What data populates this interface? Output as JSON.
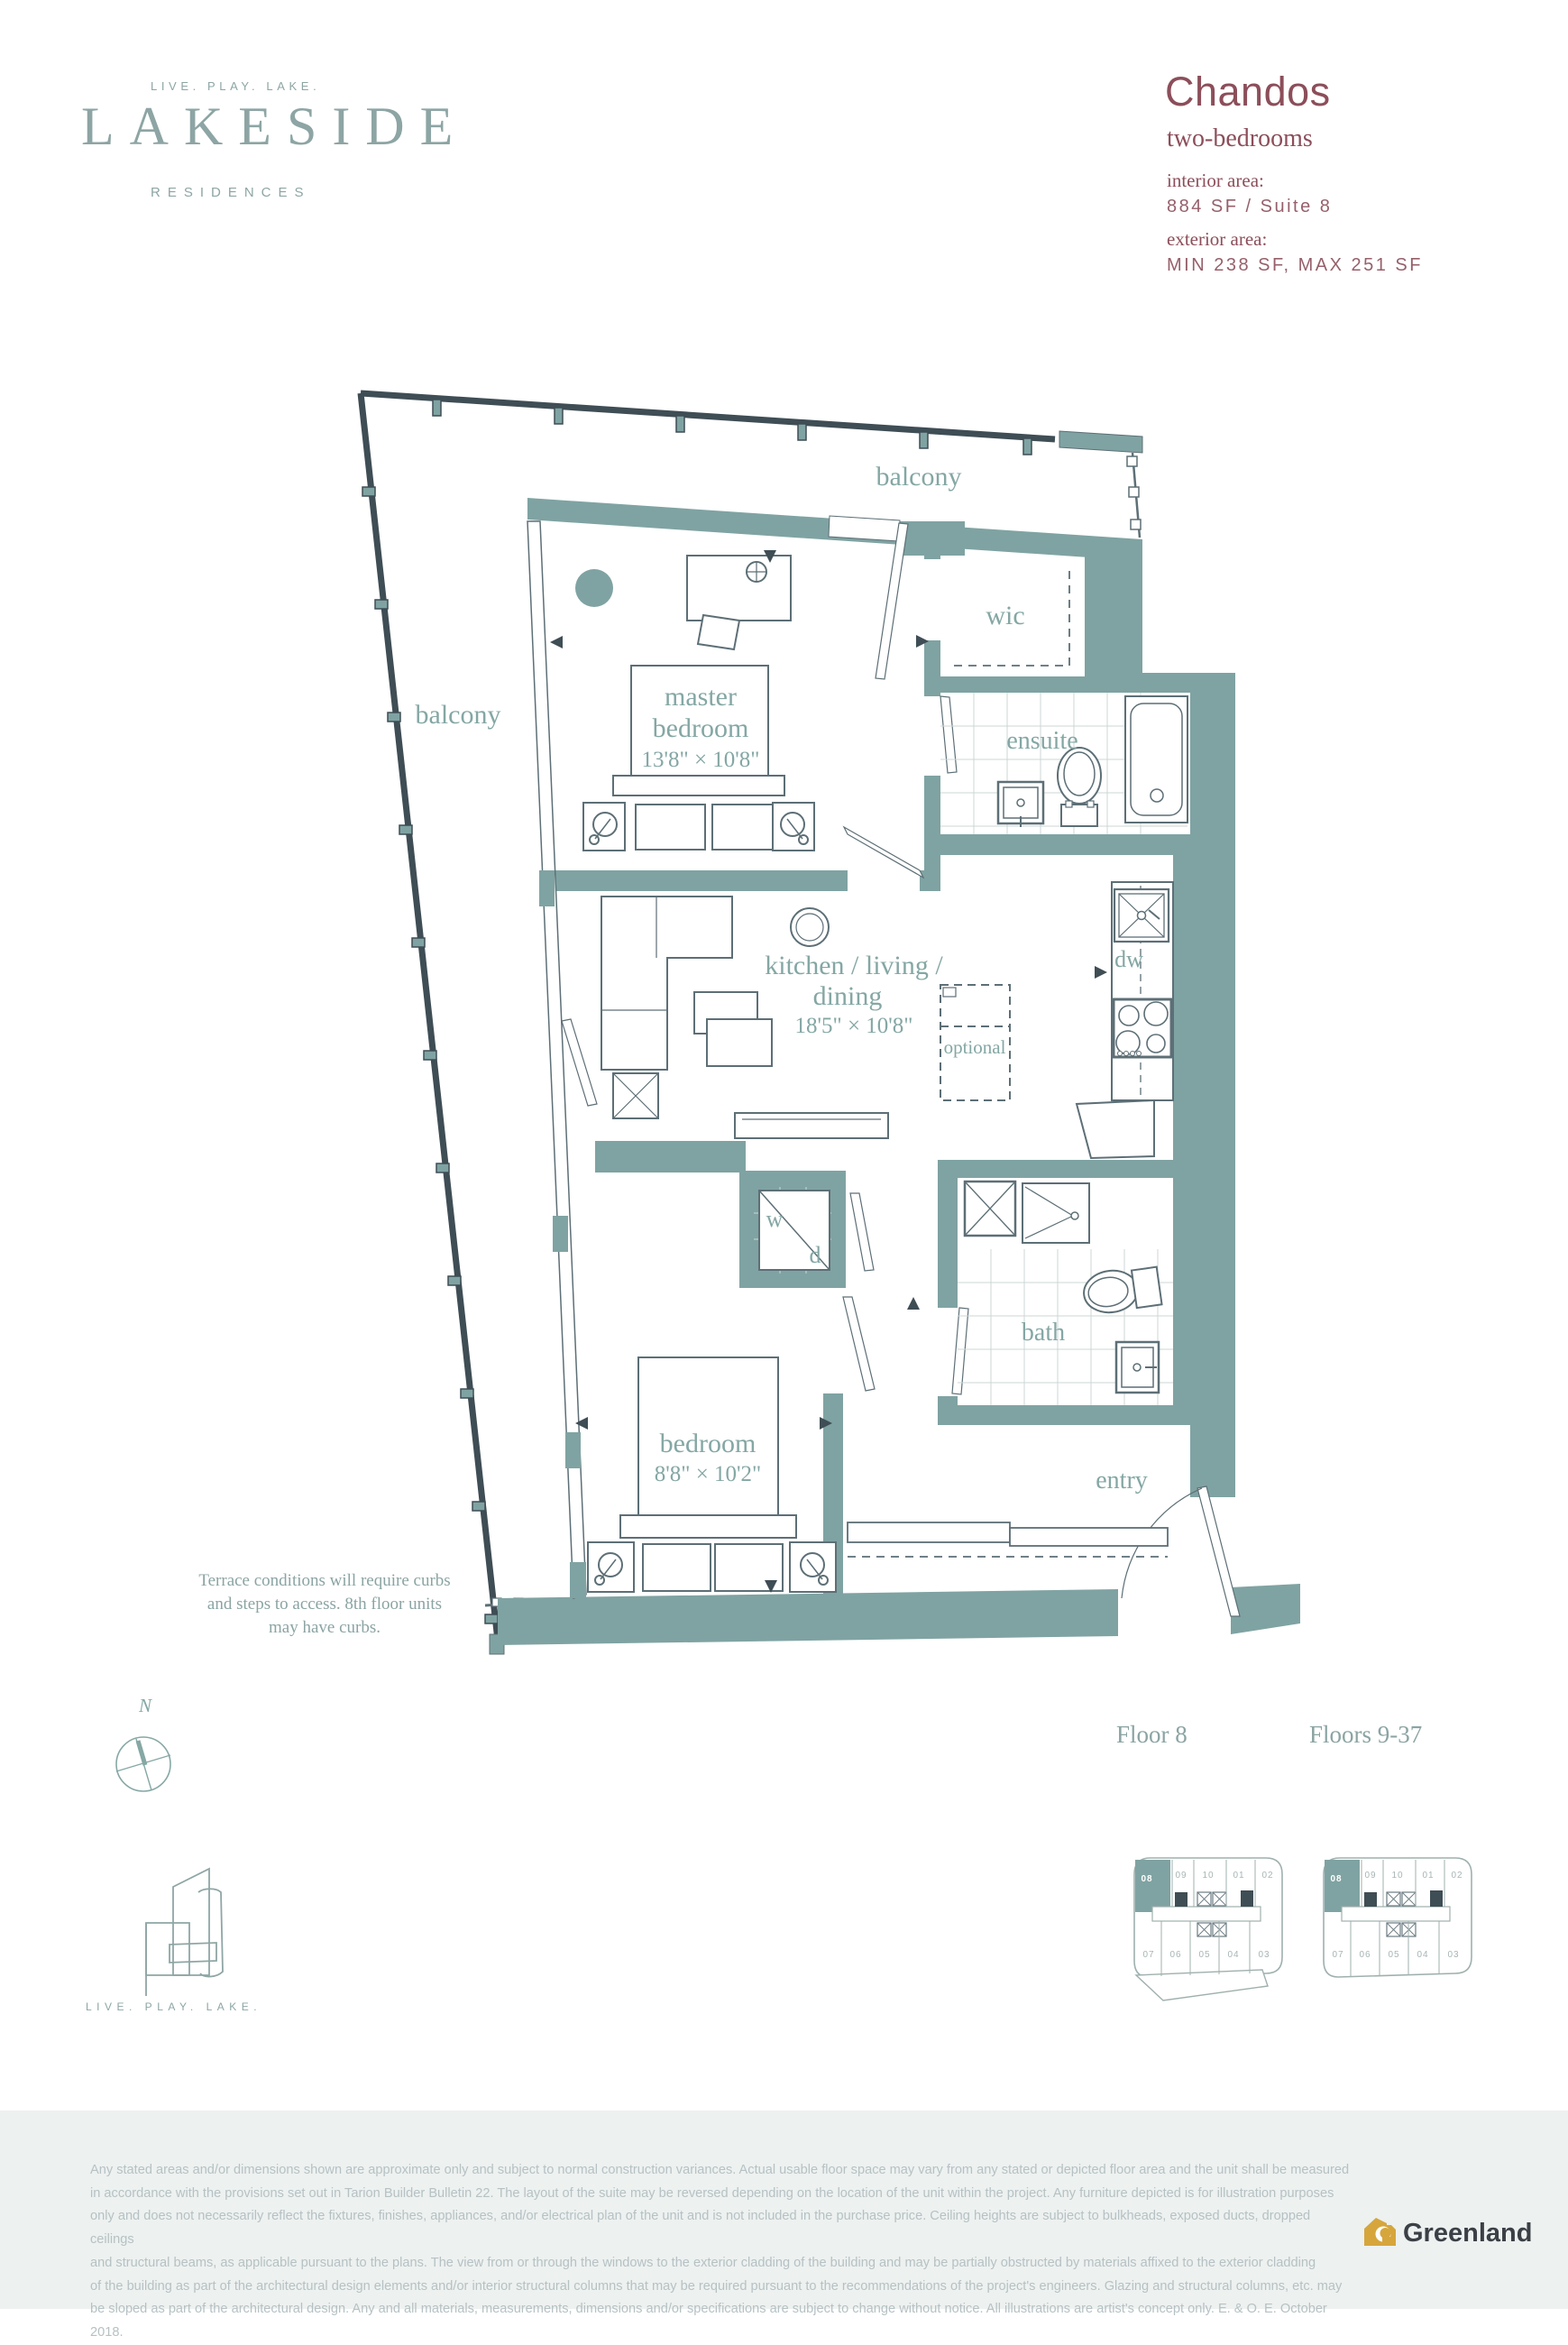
{
  "brand": {
    "tagline": "LIVE. PLAY. LAKE.",
    "name": "LAKESIDE",
    "subname": "RESIDENCES"
  },
  "unit": {
    "name": "Chandos",
    "type": "two-bedrooms",
    "interior_label": "interior area:",
    "interior_value": "884 SF / Suite 8",
    "exterior_label": "exterior area:",
    "exterior_value": "MIN 238 SF, MAX 251 SF"
  },
  "plan": {
    "labels": {
      "balcony_top": "balcony",
      "balcony_left": "balcony",
      "wic": "wic",
      "master_1": "master",
      "master_2": "bedroom",
      "master_dims": "13'8\" × 10'8\"",
      "ensuite": "ensuite",
      "kld_1": "kitchen / living /",
      "kld_2": "dining",
      "kld_dims": "18'5\" × 10'8\"",
      "dw": "dw",
      "optional": "optional",
      "washer": "w",
      "dryer": "d",
      "bath": "bath",
      "bedroom": "bedroom",
      "bedroom_dims": "8'8\" × 10'2\"",
      "entry": "entry"
    },
    "note_lines": [
      "Terrace conditions will require curbs",
      "and steps to access. 8th floor units",
      "may have curbs."
    ],
    "compass_n": "N"
  },
  "floors": {
    "floor8": "Floor 8",
    "floors937": "Floors 9-37"
  },
  "keyplan": {
    "top_units": [
      "08",
      "09",
      "10",
      "01",
      "02"
    ],
    "bottom_units": [
      "07",
      "06",
      "05",
      "04",
      "03"
    ],
    "highlighted": "08"
  },
  "footer": {
    "tagline": "LIVE. PLAY. LAKE.",
    "disclaimer_lines": [
      "Any stated areas and/or dimensions shown are approximate only and subject to normal construction variances. Actual usable floor space may vary from any stated or depicted floor area and the unit shall be measured",
      "in accordance with the provisions set out in Tarion Builder Bulletin 22. The layout of the suite may be reversed depending on the location of the unit within the project. Any furniture depicted is for illustration purposes",
      "only and does not necessarily reflect the fixtures, finishes, appliances, and/or electrical plan of the unit and is not included in the purchase price. Ceiling heights are subject to bulkheads, exposed ducts, dropped ceilings",
      "and structural beams, as applicable pursuant to the plans. The view from or through the windows to the exterior cladding of the building and may be partially obstructed by materials affixed to the exterior cladding",
      "of the building as part of the architectural design elements and/or interior structural columns that may be required pursuant to the recommendations of the project's engineers. Glazing and structural columns, etc. may",
      "be sloped as part of the architectural design. Any and all materials, measurements, dimensions and/or specifications are subject to change without notice. All illustrations are artist's concept only. E. & O. E. October 2018."
    ],
    "logo_text": "Greenland"
  },
  "colors": {
    "wall": "#7fa3a2",
    "label": "#84a7a4",
    "maroon": "#8c4e5a",
    "brand": "#8da5a4",
    "rail": "#3f4d55",
    "gold": "#d6a63c"
  }
}
